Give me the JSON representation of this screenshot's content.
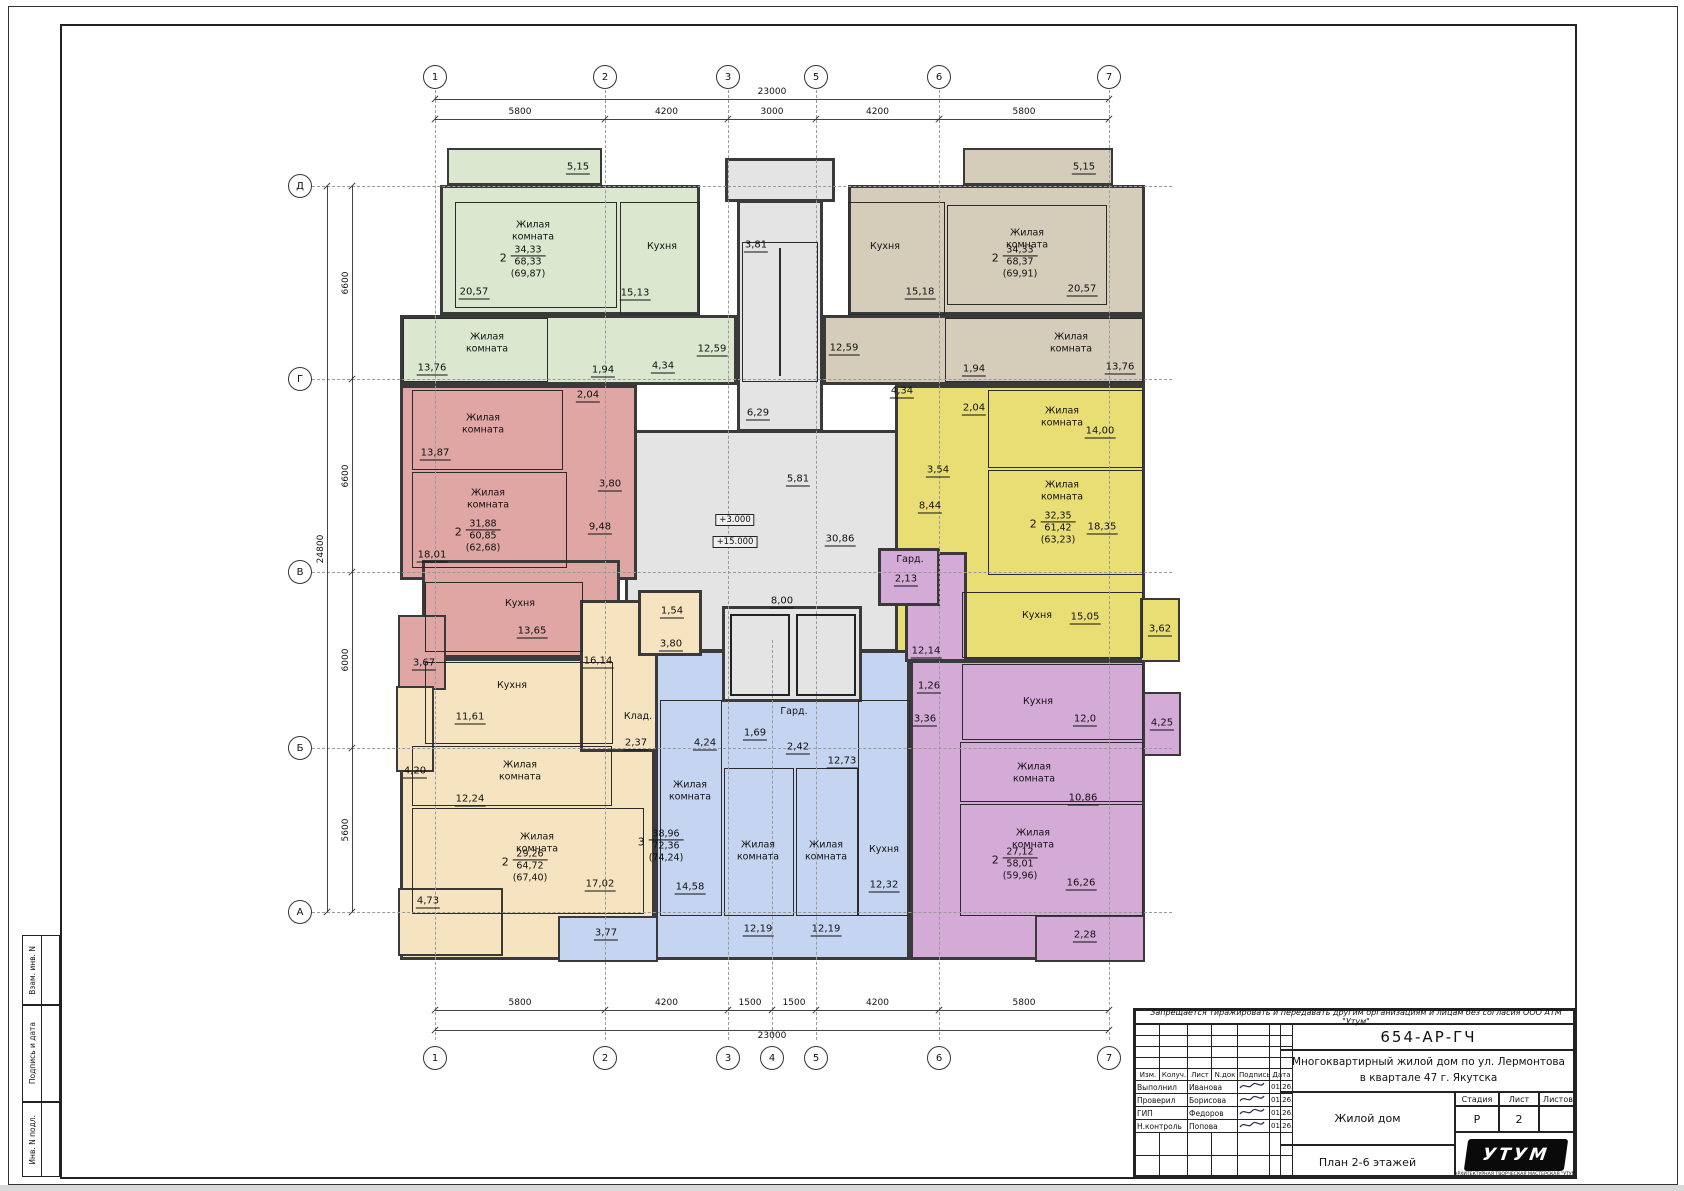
{
  "axes": {
    "top": [
      {
        "label": "1",
        "x": 435
      },
      {
        "label": "2",
        "x": 605
      },
      {
        "label": "3",
        "x": 728
      },
      {
        "label": "5",
        "x": 816
      },
      {
        "label": "6",
        "x": 939
      },
      {
        "label": "7",
        "x": 1109
      }
    ],
    "bottom": [
      {
        "label": "1",
        "x": 435
      },
      {
        "label": "2",
        "x": 605
      },
      {
        "label": "3",
        "x": 728
      },
      {
        "label": "4",
        "x": 772
      },
      {
        "label": "5",
        "x": 816
      },
      {
        "label": "6",
        "x": 939
      },
      {
        "label": "7",
        "x": 1109
      }
    ],
    "left": [
      {
        "label": "Д",
        "y": 186
      },
      {
        "label": "Г",
        "y": 379
      },
      {
        "label": "В",
        "y": 572
      },
      {
        "label": "Б",
        "y": 748
      },
      {
        "label": "А",
        "y": 912
      }
    ]
  },
  "dims": {
    "top_total": {
      "label": "23000",
      "x1": 435,
      "x2": 1109,
      "y": 99
    },
    "top_segs": {
      "y": 119,
      "segs": [
        {
          "t": "5800",
          "x1": 435,
          "x2": 605
        },
        {
          "t": "4200",
          "x1": 605,
          "x2": 728
        },
        {
          "t": "3000",
          "x1": 728,
          "x2": 816
        },
        {
          "t": "4200",
          "x1": 816,
          "x2": 939
        },
        {
          "t": "5800",
          "x1": 939,
          "x2": 1109
        }
      ]
    },
    "bot_segs": {
      "y": 1010,
      "segs": [
        {
          "t": "5800",
          "x1": 435,
          "x2": 605
        },
        {
          "t": "4200",
          "x1": 605,
          "x2": 728
        },
        {
          "t": "1500",
          "x1": 728,
          "x2": 772
        },
        {
          "t": "1500",
          "x1": 772,
          "x2": 816
        },
        {
          "t": "4200",
          "x1": 816,
          "x2": 939
        },
        {
          "t": "5800",
          "x1": 939,
          "x2": 1109
        }
      ]
    },
    "bot_total": {
      "label": "23000",
      "x1": 435,
      "x2": 1109,
      "y": 1030
    },
    "left_total": {
      "label": "24800",
      "y1": 186,
      "y2": 912,
      "x": 327
    },
    "left_segs": {
      "x": 352,
      "segs": [
        {
          "t": "6600",
          "y1": 186,
          "y2": 379
        },
        {
          "t": "6600",
          "y1": 379,
          "y2": 572
        },
        {
          "t": "6000",
          "y1": 572,
          "y2": 748
        },
        {
          "t": "5600",
          "y1": 748,
          "y2": 912
        }
      ]
    }
  },
  "core": {
    "color": "#e4e4e4",
    "rects": [
      [
        725,
        158,
        110,
        44
      ],
      [
        737,
        200,
        86,
        232
      ],
      [
        625,
        430,
        295,
        222
      ]
    ],
    "overlays": [
      [
        722,
        606,
        140,
        96
      ]
    ],
    "stair_treads": [
      742,
      242,
      76,
      140
    ],
    "shafts": [
      [
        730,
        614,
        60,
        82
      ],
      [
        796,
        614,
        60,
        82
      ]
    ],
    "labels": [
      {
        "t": "3,81",
        "x": 756,
        "y": 246
      },
      {
        "t": "6,29",
        "x": 758,
        "y": 414
      },
      {
        "t": "5,81",
        "x": 798,
        "y": 480
      },
      {
        "t": "30,86",
        "x": 840,
        "y": 540
      },
      {
        "t": "8,00",
        "x": 782,
        "y": 602
      }
    ],
    "elevations": [
      {
        "t": "+3.000",
        "x": 735,
        "y": 520
      },
      {
        "t": "+15.000",
        "x": 735,
        "y": 542
      }
    ]
  },
  "apartments": [
    {
      "id": "apt-green",
      "color": "#dbe8cf",
      "rects": [
        [
          440,
          185,
          260,
          130
        ],
        [
          400,
          315,
          337,
          70
        ]
      ],
      "balconies": [
        {
          "box": [
            447,
            148,
            155,
            37
          ]
        }
      ],
      "rooms": [
        {
          "name": "Жилая\nкомната",
          "box": [
            455,
            202,
            162,
            106
          ],
          "name_xy": [
            533,
            232
          ],
          "area": "20,57",
          "area_xy": [
            474,
            293
          ]
        },
        {
          "name": "Кухня",
          "box": [
            620,
            202,
            80,
            113
          ],
          "name_xy": [
            662,
            247
          ],
          "area": "15,13",
          "area_xy": [
            635,
            294
          ]
        },
        {
          "name": "Жилая\nкомната",
          "box": [
            403,
            318,
            145,
            64
          ],
          "name_xy": [
            487,
            344
          ],
          "area": "13,76",
          "area_xy": [
            432,
            369
          ]
        }
      ],
      "labels": [
        {
          "t": "5,15",
          "x": 578,
          "y": 168
        },
        {
          "t": "12,59",
          "x": 712,
          "y": 350
        },
        {
          "t": "1,94",
          "x": 603,
          "y": 371
        },
        {
          "t": "4,34",
          "x": 663,
          "y": 367
        }
      ],
      "formula": {
        "x": 528,
        "y": 262,
        "rooms": "2",
        "living": "34,33",
        "total": "68,33",
        "with_balcony": "(69,87)"
      }
    },
    {
      "id": "apt-beige",
      "color": "#d5cdba",
      "rects": [
        [
          848,
          185,
          297,
          130
        ],
        [
          823,
          315,
          322,
          70
        ]
      ],
      "balconies": [
        {
          "box": [
            963,
            148,
            150,
            37
          ]
        }
      ],
      "rooms": [
        {
          "name": "Кухня",
          "box": [
            848,
            202,
            97,
            113
          ],
          "name_xy": [
            885,
            247
          ],
          "area": "15,18",
          "area_xy": [
            920,
            293
          ]
        },
        {
          "name": "Жилая\nкомната",
          "box": [
            947,
            205,
            160,
            100
          ],
          "name_xy": [
            1027,
            240
          ],
          "area": "20,57",
          "area_xy": [
            1082,
            290
          ]
        },
        {
          "name": "Жилая\nкомната",
          "box": [
            945,
            318,
            198,
            64
          ],
          "name_xy": [
            1071,
            344
          ],
          "area": "13,76",
          "area_xy": [
            1120,
            368
          ]
        }
      ],
      "labels": [
        {
          "t": "5,15",
          "x": 1084,
          "y": 168
        },
        {
          "t": "12,59",
          "x": 844,
          "y": 349
        },
        {
          "t": "1,94",
          "x": 974,
          "y": 370
        },
        {
          "t": "4,34",
          "x": 902,
          "y": 392
        }
      ],
      "formula": {
        "x": 1020,
        "y": 262,
        "rooms": "2",
        "living": "34,33",
        "total": "68,37",
        "with_balcony": "(69,91)"
      }
    },
    {
      "id": "apt-red",
      "color": "#dfa6a4",
      "rects": [
        [
          400,
          385,
          237,
          195
        ],
        [
          422,
          560,
          198,
          98
        ]
      ],
      "balconies": [
        {
          "box": [
            398,
            615,
            48,
            75
          ]
        }
      ],
      "rooms": [
        {
          "name": "Жилая\nкомната",
          "box": [
            412,
            390,
            151,
            80
          ],
          "name_xy": [
            483,
            425
          ],
          "area": "13,87",
          "area_xy": [
            435,
            454
          ]
        },
        {
          "name": "Жилая\nкомната",
          "box": [
            412,
            472,
            155,
            96
          ],
          "name_xy": [
            488,
            500
          ],
          "area": "18,01",
          "area_xy": [
            432,
            556
          ]
        },
        {
          "name": "Кухня",
          "box": [
            425,
            582,
            158,
            70
          ],
          "name_xy": [
            520,
            604
          ],
          "area": "13,65",
          "area_xy": [
            532,
            632
          ]
        }
      ],
      "labels": [
        {
          "t": "2,04",
          "x": 588,
          "y": 396
        },
        {
          "t": "3,80",
          "x": 610,
          "y": 485
        },
        {
          "t": "9,48",
          "x": 600,
          "y": 528
        },
        {
          "t": "3,67",
          "x": 424,
          "y": 664
        }
      ],
      "formula": {
        "x": 483,
        "y": 536,
        "rooms": "2",
        "living": "31,88",
        "total": "60,85",
        "with_balcony": "(62,68)"
      }
    },
    {
      "id": "apt-yellow",
      "color": "#e9de74",
      "rects": [
        [
          895,
          385,
          250,
          275
        ]
      ],
      "balconies": [
        {
          "box": [
            1140,
            598,
            40,
            64
          ]
        }
      ],
      "rooms": [
        {
          "name": "Жилая\nкомната",
          "box": [
            988,
            390,
            155,
            78
          ],
          "name_xy": [
            1062,
            418
          ],
          "area": "14,00",
          "area_xy": [
            1100,
            432
          ]
        },
        {
          "name": "Жилая\nкомната",
          "box": [
            988,
            470,
            155,
            105
          ],
          "name_xy": [
            1062,
            492
          ],
          "area": "18,35",
          "area_xy": [
            1102,
            528
          ]
        },
        {
          "name": "Кухня",
          "box": [
            962,
            592,
            181,
            66
          ],
          "name_xy": [
            1037,
            616
          ],
          "area": "15,05",
          "area_xy": [
            1085,
            618
          ]
        }
      ],
      "labels": [
        {
          "t": "2,04",
          "x": 974,
          "y": 409
        },
        {
          "t": "3,54",
          "x": 938,
          "y": 471
        },
        {
          "t": "8,44",
          "x": 930,
          "y": 507
        },
        {
          "t": "3,62",
          "x": 1160,
          "y": 630
        }
      ],
      "formula": {
        "x": 1058,
        "y": 528,
        "rooms": "2",
        "living": "32,35",
        "total": "61,42",
        "with_balcony": "(63,23)"
      }
    },
    {
      "id": "apt-blue",
      "color": "#c5d4f0",
      "rects": [
        [
          655,
          650,
          255,
          310
        ]
      ],
      "balconies": [
        {
          "box": [
            558,
            916,
            100,
            46
          ]
        }
      ],
      "rooms": [
        {
          "name": "Жилая\nкомната",
          "box": [
            660,
            700,
            62,
            216
          ],
          "name_xy": [
            690,
            792
          ],
          "area": "14,58",
          "area_xy": [
            690,
            888
          ]
        },
        {
          "name": "Жилая\nкомната",
          "box": [
            724,
            768,
            70,
            148
          ],
          "name_xy": [
            758,
            852
          ],
          "area": "12,19",
          "area_xy": [
            758,
            930
          ]
        },
        {
          "name": "Жилая\nкомната",
          "box": [
            796,
            768,
            62,
            148
          ],
          "name_xy": [
            826,
            852
          ],
          "area": "12,19",
          "area_xy": [
            826,
            930
          ]
        },
        {
          "name": "Кухня",
          "box": [
            858,
            700,
            52,
            216
          ],
          "name_xy": [
            884,
            850
          ],
          "area": "12,32",
          "area_xy": [
            884,
            886
          ]
        }
      ],
      "labels": [
        {
          "t": "4,24",
          "x": 705,
          "y": 744
        },
        {
          "t": "1,69",
          "x": 755,
          "y": 734
        },
        {
          "t": "Гард.",
          "x": 794,
          "y": 712,
          "kind": "name"
        },
        {
          "t": "2,42",
          "x": 798,
          "y": 748
        },
        {
          "t": "12,73",
          "x": 842,
          "y": 762
        },
        {
          "t": "3,77",
          "x": 606,
          "y": 934
        }
      ],
      "formula": {
        "x": 666,
        "y": 846,
        "rooms": "3",
        "living": "38,96",
        "total": "72,36",
        "with_balcony": "(74,24)"
      }
    },
    {
      "id": "apt-cream",
      "color": "#f6e4c0",
      "rects": [
        [
          400,
          658,
          255,
          302
        ],
        [
          580,
          600,
          78,
          152
        ],
        [
          638,
          590,
          64,
          66
        ]
      ],
      "balconies": [
        {
          "box": [
            396,
            686,
            38,
            86
          ]
        },
        {
          "box": [
            398,
            888,
            105,
            68
          ]
        }
      ],
      "rooms": [
        {
          "name": "Кухня",
          "box": [
            425,
            662,
            188,
            82
          ],
          "name_xy": [
            512,
            686
          ],
          "area": "11,61",
          "area_xy": [
            470,
            718
          ]
        },
        {
          "name": "Жилая\nкомната",
          "box": [
            412,
            746,
            200,
            60
          ],
          "name_xy": [
            520,
            772
          ],
          "area": "12,24",
          "area_xy": [
            470,
            800
          ]
        },
        {
          "name": "Жилая\nкомната",
          "box": [
            412,
            808,
            232,
            106
          ],
          "name_xy": [
            537,
            844
          ],
          "area": "17,02",
          "area_xy": [
            600,
            885
          ]
        }
      ],
      "labels": [
        {
          "t": "16,14",
          "x": 598,
          "y": 662
        },
        {
          "t": "1,54",
          "x": 672,
          "y": 612
        },
        {
          "t": "3,80",
          "x": 671,
          "y": 645
        },
        {
          "t": "Клад.",
          "x": 638,
          "y": 717,
          "kind": "name"
        },
        {
          "t": "2,37",
          "x": 636,
          "y": 744
        },
        {
          "t": "4,20",
          "x": 415,
          "y": 772
        },
        {
          "t": "4,73",
          "x": 428,
          "y": 902
        }
      ],
      "formula": {
        "x": 530,
        "y": 866,
        "rooms": "2",
        "living": "29,26",
        "total": "64,72",
        "with_balcony": "(67,40)"
      }
    },
    {
      "id": "apt-purple",
      "color": "#d4aad7",
      "rects": [
        [
          905,
          552,
          62,
          110
        ],
        [
          910,
          660,
          235,
          300
        ],
        [
          878,
          548,
          62,
          58
        ]
      ],
      "balconies": [
        {
          "box": [
            1035,
            915,
            110,
            47
          ]
        },
        {
          "box": [
            1143,
            692,
            38,
            64
          ]
        }
      ],
      "rooms": [
        {
          "name": "Кухня",
          "box": [
            962,
            664,
            181,
            76
          ],
          "name_xy": [
            1038,
            702
          ],
          "area": "12,0",
          "area_xy": [
            1085,
            720
          ]
        },
        {
          "name": "Жилая\nкомната",
          "box": [
            960,
            742,
            183,
            60
          ],
          "name_xy": [
            1034,
            774
          ],
          "area": "10,86",
          "area_xy": [
            1083,
            799
          ]
        },
        {
          "name": "Жилая\nкомната",
          "box": [
            960,
            804,
            183,
            112
          ],
          "name_xy": [
            1033,
            840
          ],
          "area": "16,26",
          "area_xy": [
            1081,
            884
          ]
        }
      ],
      "labels": [
        {
          "t": "Гард.",
          "x": 910,
          "y": 560,
          "kind": "name"
        },
        {
          "t": "2,13",
          "x": 906,
          "y": 580
        },
        {
          "t": "12,14",
          "x": 926,
          "y": 652
        },
        {
          "t": "1,26",
          "x": 929,
          "y": 687
        },
        {
          "t": "3,36",
          "x": 925,
          "y": 720
        },
        {
          "t": "2,28",
          "x": 1085,
          "y": 936
        },
        {
          "t": "4,25",
          "x": 1162,
          "y": 724
        }
      ],
      "formula": {
        "x": 1020,
        "y": 864,
        "rooms": "2",
        "living": "27,12",
        "total": "58,01",
        "with_balcony": "(59,96)"
      }
    }
  ],
  "title_block": {
    "warning": "Запрещается тиражировать и передавать другим организациям и лицам без согласия ООО АТМ \"Утум\"",
    "doc_number": "654-АР-ГЧ",
    "project_line1": "Многоквартирный жилой дом по ул. Лермонтова",
    "project_line2": "в квартале 47 г. Якутска",
    "object": "Жилой дом",
    "sheet_title": "План 2-6 этажей",
    "stage_header": [
      "Стадия",
      "Лист",
      "Листов"
    ],
    "stage_values": [
      "Р",
      "2",
      ""
    ],
    "grid_headers": [
      "Изм.",
      "Колуч.",
      "Лист",
      "N.док",
      "Подпись",
      "Дата"
    ],
    "rows": [
      {
        "role": "Выполнил",
        "name": "Иванова",
        "date": "01.26."
      },
      {
        "role": "Проверил",
        "name": "Борисова",
        "date": "01.26."
      },
      {
        "role": "ГИП",
        "name": "Федоров",
        "date": "01.26."
      },
      {
        "role": "Н.контроль",
        "name": "Попова",
        "date": "01.26."
      }
    ],
    "logo_text": "УТУМ",
    "logo_caption": "АРХИТЕКТУРНАЯ ТВОРЧЕСКАЯ МАСТЕРСКАЯ \"УТУМ\""
  },
  "stamp_side": [
    "Взам. инв. N",
    "Подпись и дата",
    "Инв. N подл."
  ]
}
